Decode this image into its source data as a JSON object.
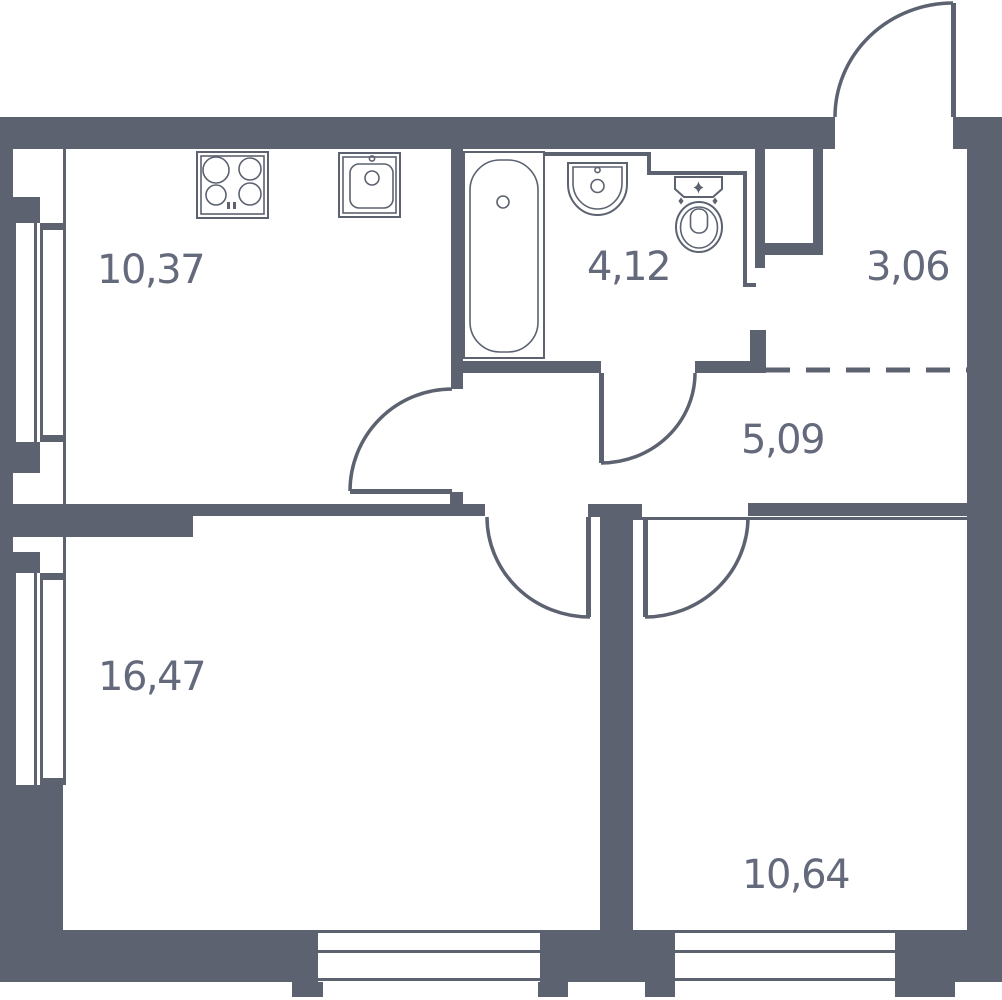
{
  "document": {
    "type": "apartment-floor-plan"
  },
  "colors": {
    "wall": "#5c6270",
    "label": "#646a7c",
    "background": "#ffffff",
    "fixture_fill": "#ffffff"
  },
  "rooms": [
    {
      "id": "kitchen",
      "area_label": "10,37"
    },
    {
      "id": "bathroom",
      "area_label": "4,12"
    },
    {
      "id": "entry-hall",
      "area_label": "3,06"
    },
    {
      "id": "hallway",
      "area_label": "5,09"
    },
    {
      "id": "living-room",
      "area_label": "16,47"
    },
    {
      "id": "bedroom",
      "area_label": "10,64"
    }
  ],
  "fixtures": [
    "cooktop",
    "kitchen-sink",
    "bathtub",
    "washbasin",
    "toilet"
  ],
  "doors": [
    "entry-door",
    "kitchen-door",
    "bathroom-door",
    "living-room-door",
    "bedroom-door"
  ],
  "windows": [
    "kitchen-window-west",
    "living-room-window-west",
    "living-room-window-south",
    "bedroom-window-south"
  ],
  "dividers": [
    "entry-hall-dashed-boundary"
  ]
}
